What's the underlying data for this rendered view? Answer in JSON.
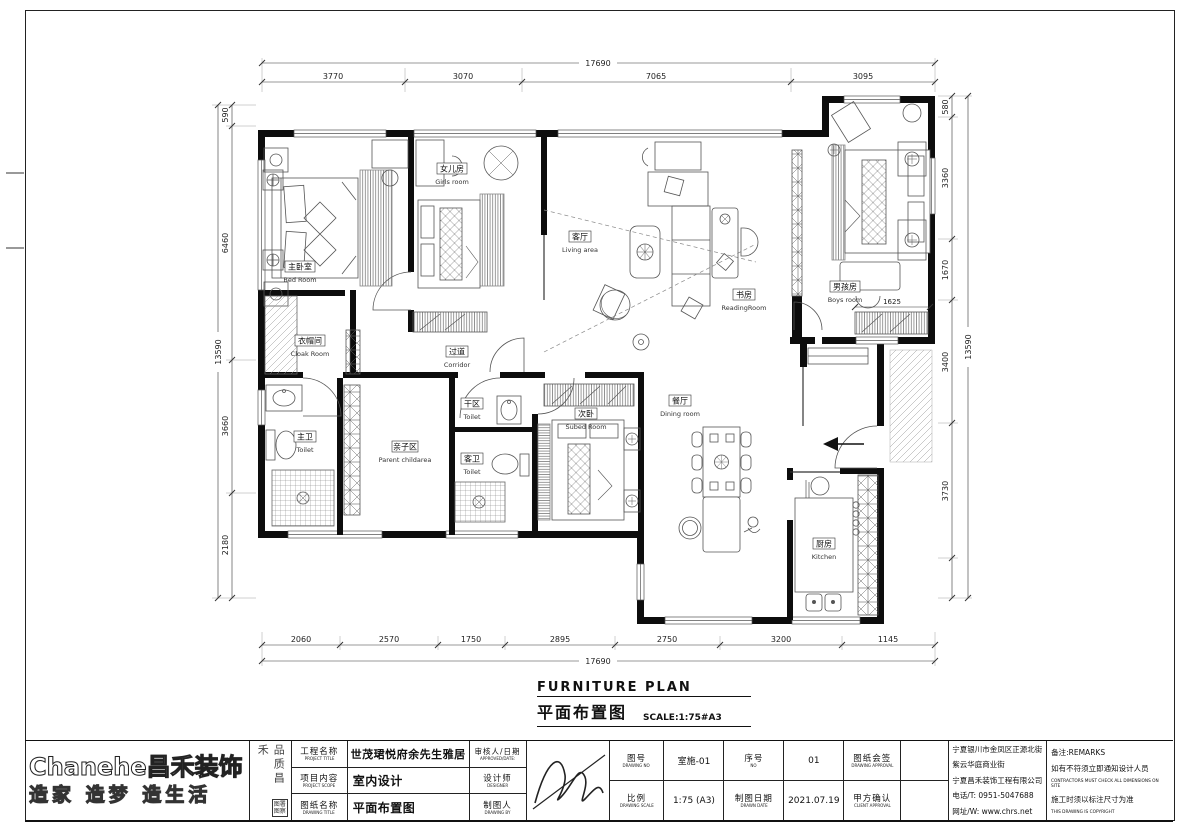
{
  "sheet": {
    "title_en": "FURNITURE PLAN",
    "title_zh": "平面布置图",
    "scale_note": "SCALE:1:75#A3"
  },
  "dims": {
    "top": [
      "3770",
      "3070",
      "7065",
      "3095"
    ],
    "top_total": "17690",
    "bottom": [
      "2060",
      "2570",
      "1750",
      "2895",
      "2750",
      "3200",
      "1145"
    ],
    "bottom_total": "17690",
    "left": [
      "590",
      "6460",
      "3660",
      "2180"
    ],
    "left_total": "13590",
    "right": [
      "580",
      "3360",
      "1670",
      "3400",
      "3730"
    ],
    "right_total": "13590",
    "boys_wardrobe": "1625"
  },
  "rooms": {
    "bedroom": {
      "zh": "主卧室",
      "en": "Bed Room"
    },
    "girls": {
      "zh": "女儿房",
      "en": "Girls room"
    },
    "living": {
      "zh": "客厅",
      "en": "Living area"
    },
    "reading": {
      "zh": "书房",
      "en": "ReadingRoom"
    },
    "boys": {
      "zh": "男孩房",
      "en": "Boys room"
    },
    "cloak": {
      "zh": "衣帽间",
      "en": "Cloak Room"
    },
    "corridor": {
      "zh": "过道",
      "en": "Corridor"
    },
    "toilet_main": {
      "zh": "主卫",
      "en": "Toilet"
    },
    "parent": {
      "zh": "亲子区",
      "en": "Parent childarea"
    },
    "toilet_dry": {
      "zh": "干区",
      "en": "Toilet"
    },
    "toilet_guest": {
      "zh": "客卫",
      "en": "Toilet"
    },
    "subed": {
      "zh": "次卧",
      "en": "Subed Room"
    },
    "dining": {
      "zh": "餐厅",
      "en": "Dining room"
    },
    "kitchen": {
      "zh": "厨房",
      "en": "Kitchen"
    }
  },
  "logo": {
    "brand": "Chanehe昌禾装饰",
    "slogan": "造家 造梦 造生活",
    "motto": "品质昌禾",
    "stamp_line1": "图署",
    "stamp_line2": "图察"
  },
  "titleblock": {
    "project_label_zh": "工程名称",
    "project_label_en": "PROJECT TITLE",
    "project_value": "世茂珺悦府余先生雅居",
    "scope_label_zh": "项目内容",
    "scope_label_en": "PROJECT SCOPE",
    "scope_value": "室内设计",
    "drawing_label_zh": "图纸名称",
    "drawing_label_en": "DRAWING TITLE",
    "drawing_value": "平面布置图",
    "approved_label_zh": "审核人/日期",
    "approved_label_en": "APPROVED/DATE:",
    "designer_label_zh": "设计师",
    "designer_label_en": "DESIGNER",
    "draftsman_label_zh": "制图人",
    "draftsman_label_en": "DRAWING BY",
    "drawing_no_label_zh": "图号",
    "drawing_no_label_en": "DRAWING NO",
    "drawing_no_value": "室施-01",
    "serial_label_zh": "序号",
    "serial_label_en": "NO",
    "serial_value": "01",
    "approval_label_zh": "图纸会签",
    "approval_label_en": "DRAWING APPROVAL",
    "scale_label_zh": "比例",
    "scale_label_en": "DRAWING SCALE",
    "scale_value": "1:75 (A3)",
    "date_label_zh": "制图日期",
    "date_label_en": "DRAWN DATE",
    "date_value": "2021.07.19",
    "client_label_zh": "甲方确认",
    "client_label_en": "CLIENT APPROVAL"
  },
  "company": {
    "address1": "宁夏银川市金凤区正源北街",
    "address2": "紫云华庭商业街",
    "name": "宁夏昌禾装饰工程有限公司",
    "phone": "电话/T: 0951-5047688",
    "website": "网址/W: www.chrs.net"
  },
  "remarks": {
    "label": "备注:REMARKS",
    "line1_zh": "如有不符须立即通知设计人员",
    "line1_en": "CONTRACTORS MUST CHECK ALL DIMENSIONS ON SITE",
    "line2_zh": "施工时须以标注尺寸为准",
    "line2_en": "THIS DRAWING IS COPYRIGHT"
  }
}
